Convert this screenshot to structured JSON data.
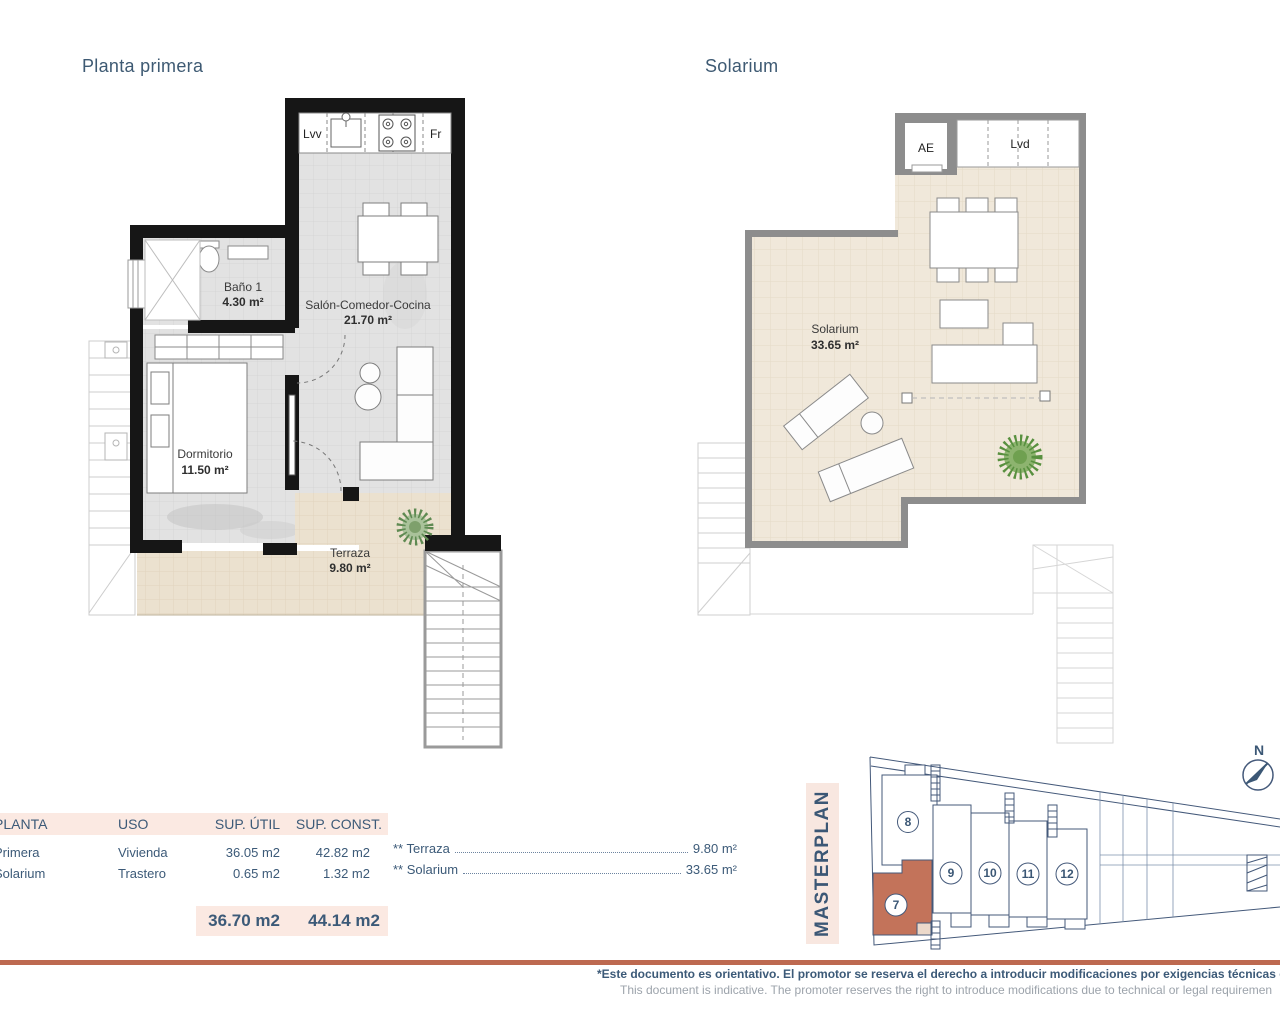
{
  "titles": {
    "plan1": "Planta primera",
    "plan2": "Solarium"
  },
  "plan1": {
    "kitchen": {
      "dishwasher": "Lvv",
      "fridge": "Fr"
    },
    "bathroom": {
      "name": "Baño 1",
      "area": "4.30 m²"
    },
    "living": {
      "name": "Salón-Comedor-Cocina",
      "area": "21.70 m²"
    },
    "bedroom": {
      "name": "Dormitorio",
      "area": "11.50 m²"
    },
    "terrace": {
      "name": "Terraza",
      "area": "9.80 m²"
    }
  },
  "plan2": {
    "elevator": "AE",
    "laundry": "Lvd",
    "solarium": {
      "name": "Solarium",
      "area": "33.65 m²"
    }
  },
  "table": {
    "headers": {
      "planta": "PLANTA",
      "uso": "USO",
      "util": "SUP. ÚTIL",
      "const": "SUP. CONST."
    },
    "rows": [
      {
        "planta": "Primera",
        "uso": "Vivienda",
        "util": "36.05 m2",
        "const": "42.82 m2"
      },
      {
        "planta": "Solarium",
        "uso": "Trastero",
        "util": "0.65 m2",
        "const": "1.32 m2"
      }
    ],
    "totals": {
      "util": "36.70 m2",
      "const": "44.14 m2"
    }
  },
  "annotations": [
    {
      "label": "** Terraza",
      "value": "9.80 m²"
    },
    {
      "label": "** Solarium",
      "value": "33.65 m²"
    }
  ],
  "masterplan": {
    "label": "MASTERPLAN",
    "compass": "N",
    "units": {
      "u7": "7",
      "u8": "8",
      "u9": "9",
      "u10": "10",
      "u11": "11",
      "u12": "12"
    },
    "highlighted_unit": "7",
    "highlight_color": "#c3735a"
  },
  "footer": {
    "es": "*Este documento es orientativo. El promotor se reserva el derecho a introducir modificaciones por exigencias técnicas o legal",
    "en": "This document is indicative. The promoter reserves the right to introduce modifications due to technical or legal requiremen"
  },
  "colors": {
    "navy": "#3c5a78",
    "terracotta": "#bd6950",
    "pink": "#fbe9e2"
  }
}
